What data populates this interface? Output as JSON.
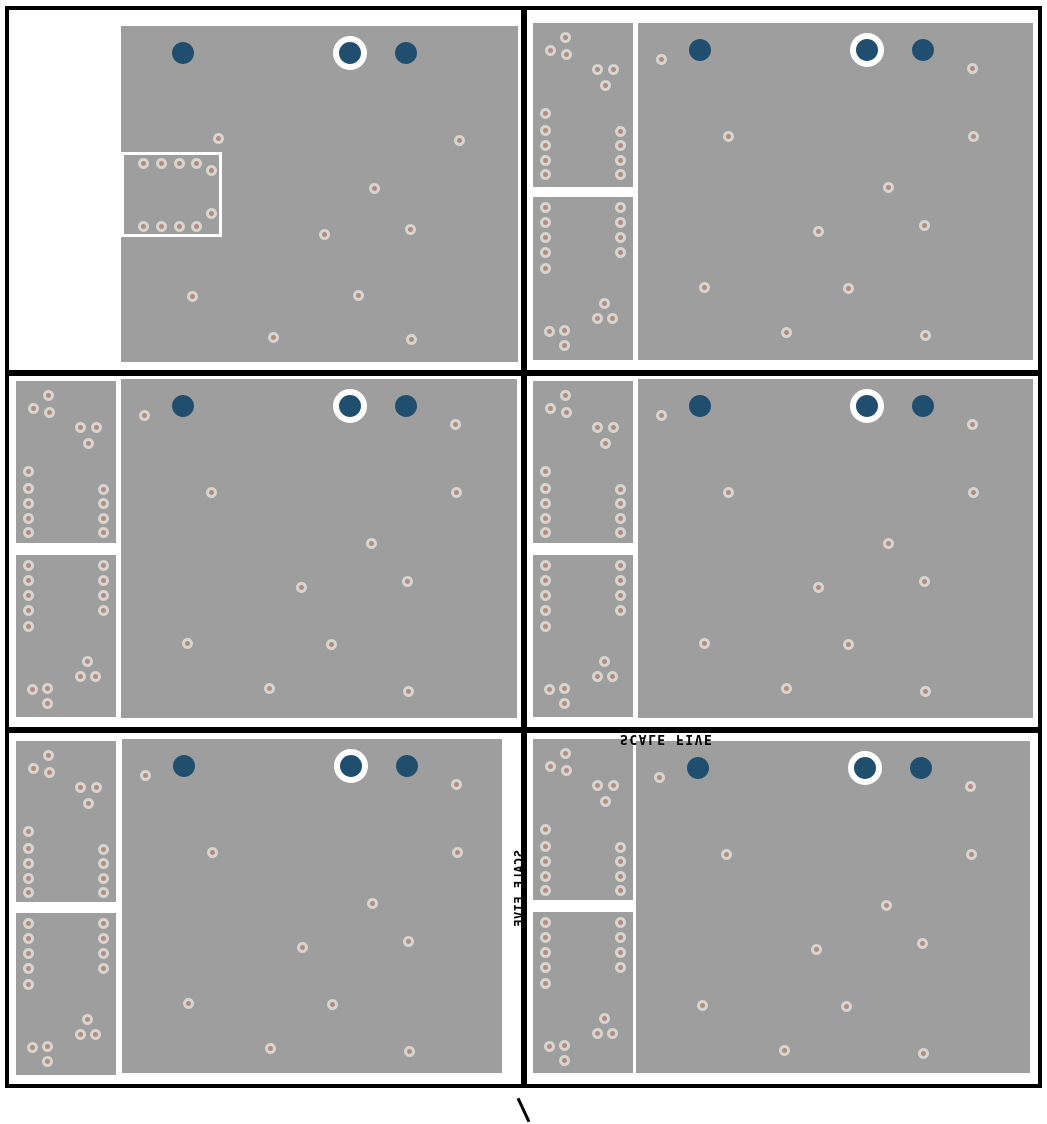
{
  "view": {
    "description": "pcb-layer-panel-grid",
    "rows": 3,
    "columns": 2
  },
  "labels": {
    "scale_note": "SCALE FIVE",
    "scale_note_vertical": "SCALE FIVE",
    "stray_mark": "\\"
  },
  "colors": {
    "background": "#ffffff",
    "frame": "#000000",
    "board_fill": "#9e9e9e",
    "hole_ring": "#d8d4d0",
    "hole_center": "#b18d7e",
    "plated_hole_blue": "#1f4e6e",
    "ring_highlight": "#ffffff"
  },
  "patterns": {
    "blue_circles": [
      {
        "x": 62,
        "y": 27,
        "ringed": false
      },
      {
        "x": 229,
        "y": 27,
        "ringed": true
      },
      {
        "x": 285,
        "y": 27,
        "ringed": false
      }
    ],
    "main_vias": [
      [
        23,
        36
      ],
      [
        334,
        45
      ],
      [
        90,
        113
      ],
      [
        335,
        113
      ],
      [
        250,
        164
      ],
      [
        180,
        208
      ],
      [
        286,
        202
      ],
      [
        66,
        264
      ],
      [
        210,
        265
      ],
      [
        148,
        309
      ],
      [
        287,
        312
      ]
    ],
    "main_vias_topleft": [
      [
        97,
        112
      ],
      [
        338,
        114
      ],
      [
        253,
        162
      ],
      [
        203,
        208
      ],
      [
        289,
        203
      ],
      [
        71,
        270
      ],
      [
        237,
        269
      ],
      [
        152,
        311
      ],
      [
        290,
        313
      ]
    ],
    "strip_top_vias": [
      [
        32,
        14
      ],
      [
        17,
        27
      ],
      [
        33,
        31
      ],
      [
        64,
        46
      ],
      [
        80,
        46
      ],
      [
        72,
        62
      ],
      [
        12,
        90
      ],
      [
        12,
        107
      ],
      [
        87,
        108
      ],
      [
        12,
        122
      ],
      [
        87,
        122
      ],
      [
        12,
        137
      ],
      [
        87,
        137
      ],
      [
        12,
        151
      ],
      [
        87,
        151
      ]
    ],
    "strip_bottom_vias": [
      [
        12,
        10
      ],
      [
        87,
        10
      ],
      [
        12,
        25
      ],
      [
        87,
        25
      ],
      [
        12,
        40
      ],
      [
        87,
        40
      ],
      [
        12,
        55
      ],
      [
        87,
        55
      ],
      [
        12,
        71
      ],
      [
        71,
        106
      ],
      [
        64,
        121
      ],
      [
        79,
        121
      ],
      [
        16,
        134
      ],
      [
        31,
        133
      ],
      [
        31,
        148
      ]
    ],
    "notch_vias": [
      [
        22,
        11
      ],
      [
        40,
        11
      ],
      [
        58,
        11
      ],
      [
        75,
        11
      ],
      [
        90,
        18
      ],
      [
        22,
        74
      ],
      [
        40,
        74
      ],
      [
        58,
        74
      ],
      [
        75,
        74
      ],
      [
        90,
        61
      ]
    ]
  },
  "panels": [
    {
      "id": "top-left",
      "main": [
        121,
        26,
        397,
        336
      ],
      "notch": [
        121,
        152,
        101,
        85
      ],
      "via_pattern": "main_vias_topleft"
    },
    {
      "id": "top-right",
      "main": [
        638,
        23,
        395,
        337
      ],
      "strip_top": [
        533,
        23,
        100,
        164
      ],
      "strip_bottom": [
        533,
        197,
        100,
        163
      ],
      "via_pattern": "main_vias"
    },
    {
      "id": "middle-left",
      "main": [
        121,
        379,
        396,
        339
      ],
      "strip_top": [
        16,
        381,
        100,
        162
      ],
      "strip_bottom": [
        16,
        555,
        100,
        162
      ],
      "via_pattern": "main_vias"
    },
    {
      "id": "middle-right",
      "main": [
        638,
        379,
        395,
        339
      ],
      "strip_top": [
        533,
        381,
        100,
        162
      ],
      "strip_bottom": [
        533,
        555,
        100,
        162
      ],
      "via_pattern": "main_vias"
    },
    {
      "id": "bottom-left",
      "main": [
        122,
        739,
        380,
        334
      ],
      "strip_top": [
        16,
        741,
        100,
        161
      ],
      "strip_bottom": [
        16,
        913,
        100,
        162
      ],
      "via_pattern": "main_vias"
    },
    {
      "id": "bottom-right",
      "main": [
        636,
        741,
        394,
        332
      ],
      "strip_top": [
        533,
        739,
        100,
        161
      ],
      "strip_bottom": [
        533,
        912,
        100,
        161
      ],
      "via_pattern": "main_vias"
    }
  ]
}
